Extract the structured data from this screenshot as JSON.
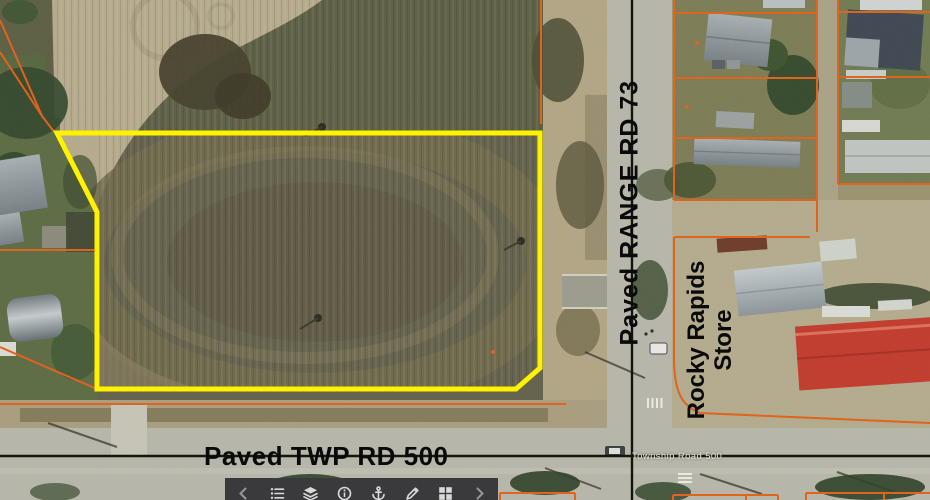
{
  "map": {
    "labels": {
      "range_road": "Paved RANGE RD 73",
      "twp_road": "Paved TWP RD 500",
      "store_line1": "Rocky Rapids",
      "store_line2": "Store",
      "township_small": "Township Road 500"
    },
    "colors": {
      "highlight": "#FFF200",
      "parcel_line": "#E0631E",
      "road_centerline": "#15150F",
      "label_text": "#0A0A0A",
      "toolbar_bg": "#3A3A3D",
      "toolbar_icon": "#D9D9D9",
      "toolbar_chevron": "#979797"
    }
  },
  "toolbar": {
    "icons": [
      {
        "name": "chevron-left-icon"
      },
      {
        "name": "legend-list-icon"
      },
      {
        "name": "layers-icon"
      },
      {
        "name": "info-icon"
      },
      {
        "name": "anchor-icon"
      },
      {
        "name": "sketch-icon"
      },
      {
        "name": "basemap-grid-icon"
      },
      {
        "name": "chevron-right-icon"
      }
    ]
  }
}
